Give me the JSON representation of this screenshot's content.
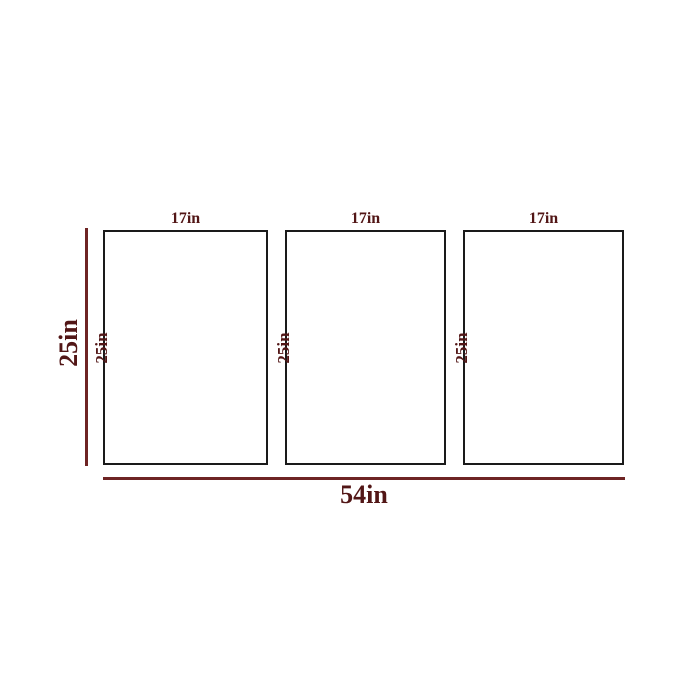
{
  "diagram": {
    "type": "product-dimension-diagram",
    "overall": {
      "height_label": "25in",
      "width_label": "54in"
    },
    "panels": [
      {
        "width_label": "17in",
        "height_label": "25in"
      },
      {
        "width_label": "17in",
        "height_label": "25in"
      },
      {
        "width_label": "17in",
        "height_label": "25in"
      }
    ],
    "colors": {
      "dimension_text": "#521616",
      "dimension_line": "#6e2424",
      "panel_border": "#1a1a1a",
      "background": "#ffffff"
    }
  }
}
